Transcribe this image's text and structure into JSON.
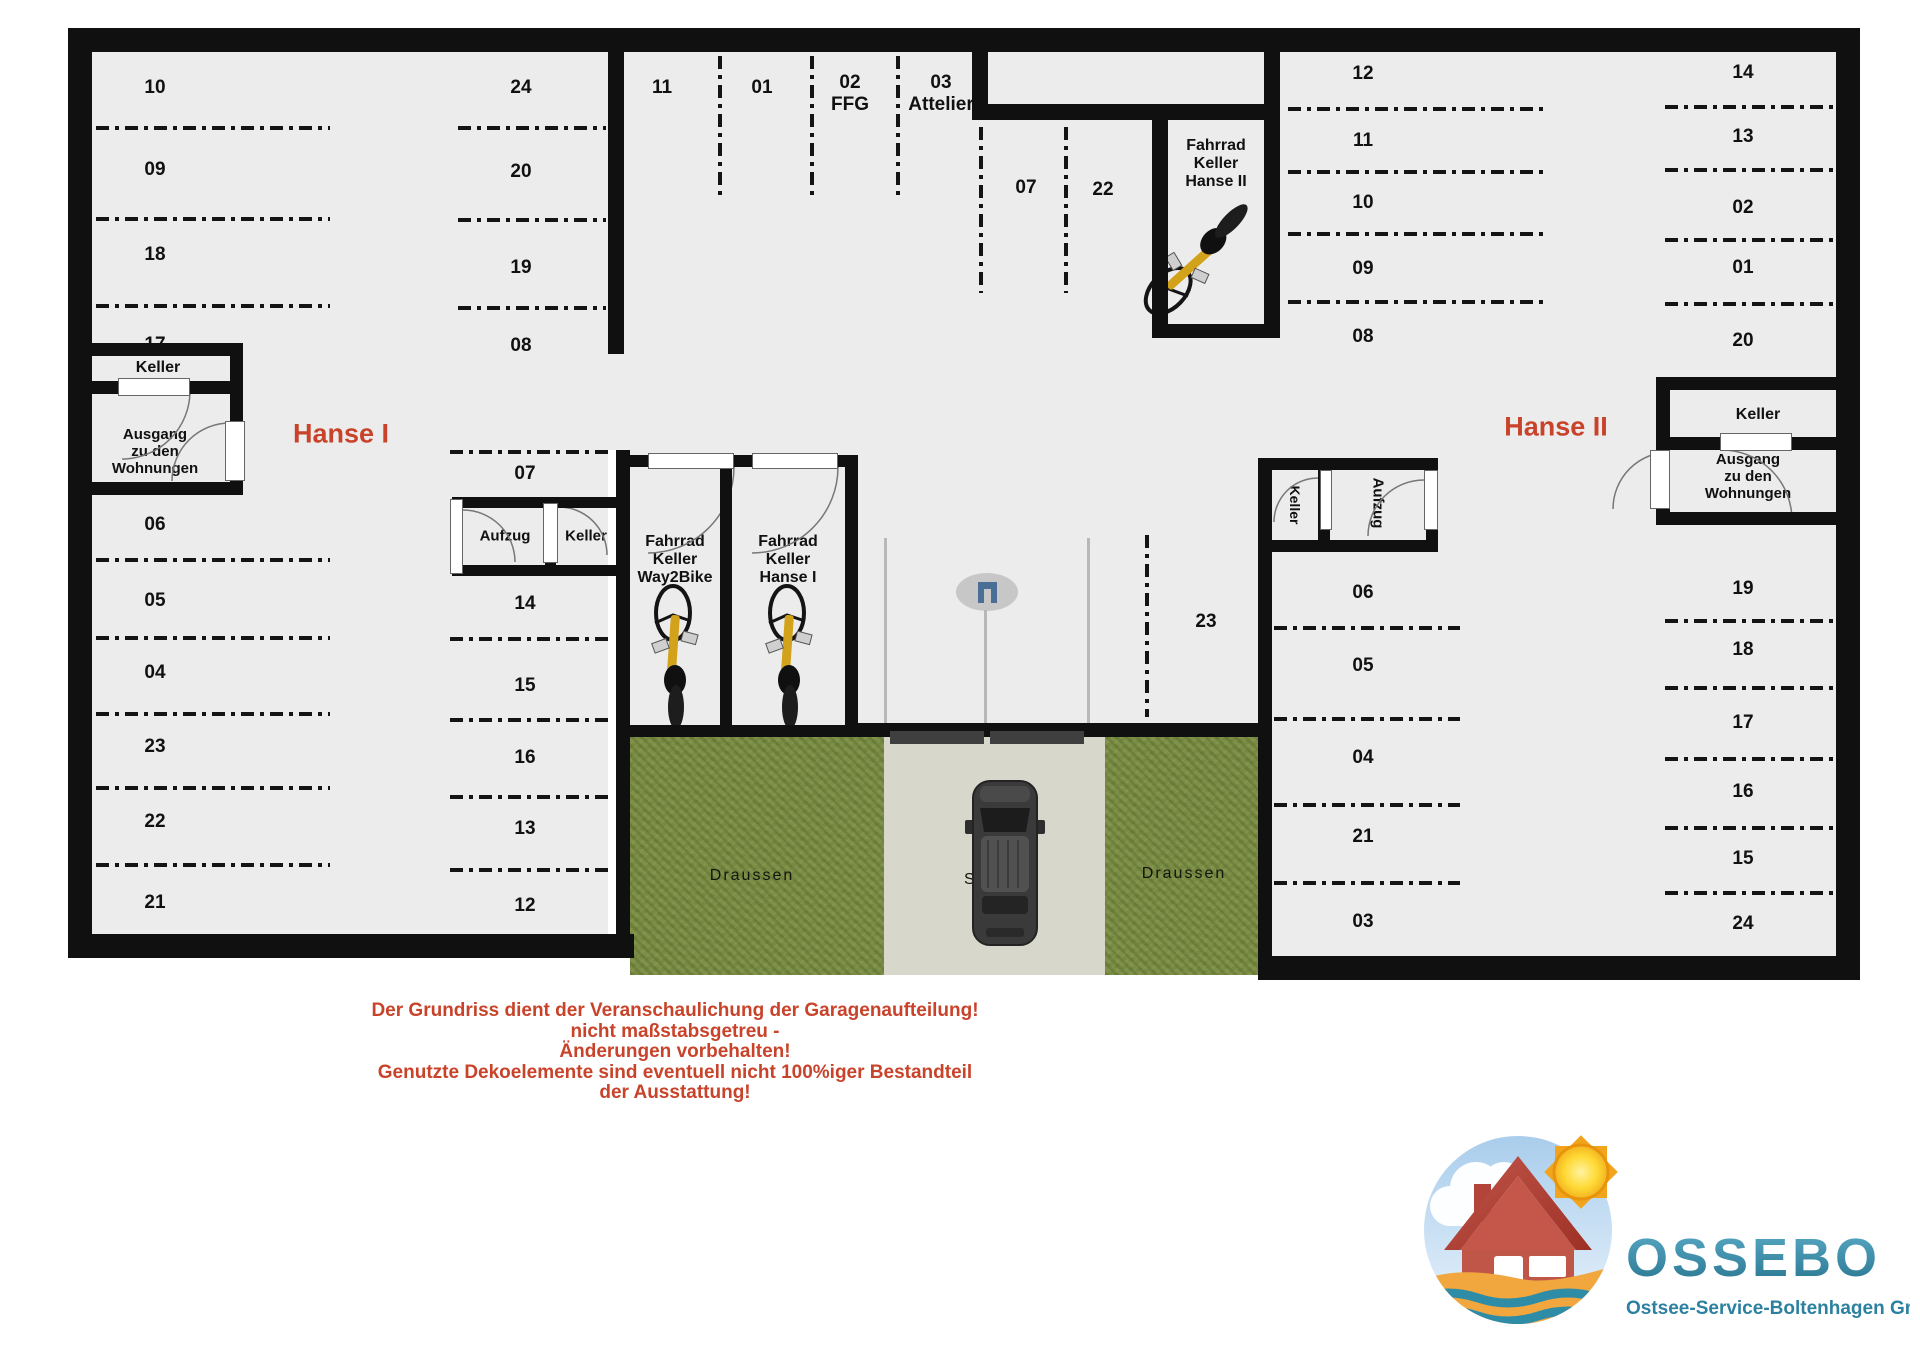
{
  "plan": {
    "building_left_label": "Hanse I",
    "building_right_label": "Hanse II",
    "zones": {
      "tlA": [
        "10",
        "09",
        "18",
        "17"
      ],
      "tlB": [
        "24",
        "20",
        "19",
        "08"
      ],
      "topmid": [
        "11",
        "01",
        "02\nFFG",
        "03\nAttelier"
      ],
      "z0722": [
        "07",
        "22"
      ],
      "trC": [
        "12",
        "11",
        "10",
        "09",
        "08"
      ],
      "trD": [
        "14",
        "13",
        "02",
        "01",
        "20"
      ],
      "left": [
        "06",
        "05",
        "04",
        "23",
        "22",
        "21"
      ],
      "mid": [
        "07",
        "14",
        "15",
        "16",
        "13",
        "12"
      ],
      "z23": [
        "23"
      ],
      "rInner": [
        "06",
        "05",
        "04",
        "21",
        "03"
      ],
      "rOuter": [
        "19",
        "18",
        "17",
        "16",
        "15",
        "24"
      ]
    },
    "rooms": {
      "keller_left": "Keller",
      "ausgang_left": "Ausgang\nzu den\nWohnungen",
      "aufzug_mid": "Aufzug",
      "keller_mid": "Keller",
      "fahrrad_way2bike": "Fahrrad\nKeller\nWay2Bike",
      "fahrrad_hanse1": "Fahrrad\nKeller\nHanse I",
      "fahrrad_hanse2": "Fahrrad\nKeller\nHanse II",
      "keller_right_small": "Keller",
      "aufzug_right": "Aufzug",
      "keller_right": "Keller",
      "ausgang_right": "Ausgang\nzu den\nWohnungen"
    },
    "outdoor": {
      "draussen_left": "Draussen",
      "strasse": "Straße",
      "draussen_right": "Draussen"
    }
  },
  "disclaimer": {
    "lines": [
      "Der Grundriss dient der Veranschaulichung der Garagenaufteilung!",
      "nicht maßstabsgetreu -",
      "Änderungen vorbehalten!",
      "Genutzte Dekoelemente sind eventuell nicht 100%iger Bestandteil",
      "der Ausstattung!"
    ]
  },
  "logo": {
    "name": "OSSEBO",
    "subtitle": "Ostsee-Service-Boltenhagen GmbH"
  },
  "colors": {
    "accent_red": "#c8432a",
    "wall": "#101010",
    "floor": "#ececec",
    "grass": "#7d8f48",
    "road": "#d7d7cc",
    "logo_blue": "#3d8fae",
    "logo_text": "#2c80a0",
    "sun_yellow": "#ffd935",
    "house_red": "#c05648",
    "sand_orange": "#f1a63e",
    "wave_teal": "#2e8ca6",
    "bike_yellow": "#d2a21a"
  }
}
